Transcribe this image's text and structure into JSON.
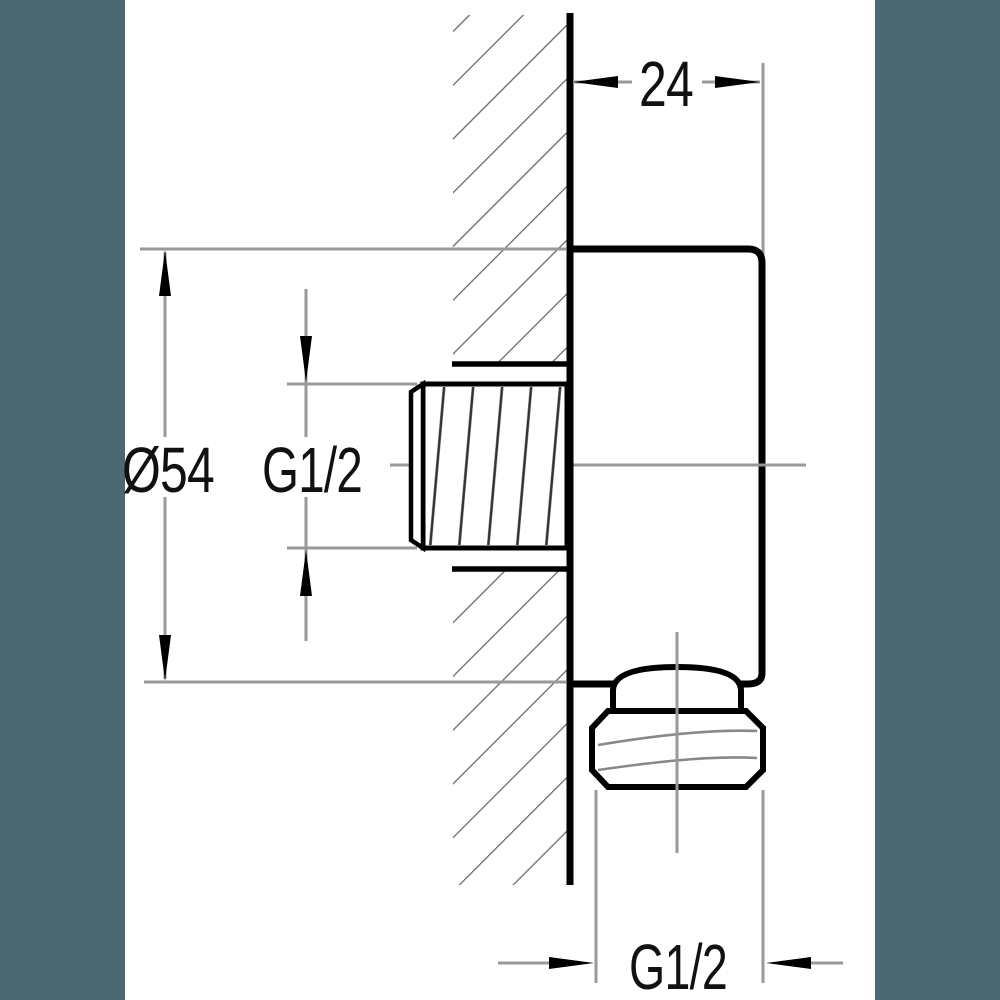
{
  "meta": {
    "kind": "technical-drawing",
    "subject": "Wall-mounted shower outlet elbow, side section view with dimensions"
  },
  "palette": {
    "background": "#4c6872",
    "paper": "#ffffff",
    "outline": "#000000",
    "wall_hatch": "#666666",
    "thread_hatch": "#333333",
    "dimension_line": "#999999",
    "text": "#111111"
  },
  "drawing": {
    "dimensions": {
      "mount_depth": {
        "label": "24"
      },
      "plate_diameter": {
        "label": "Ø54"
      },
      "inlet_thread": {
        "label": "G1/2"
      },
      "outlet_thread": {
        "label": "G1/2"
      }
    }
  }
}
